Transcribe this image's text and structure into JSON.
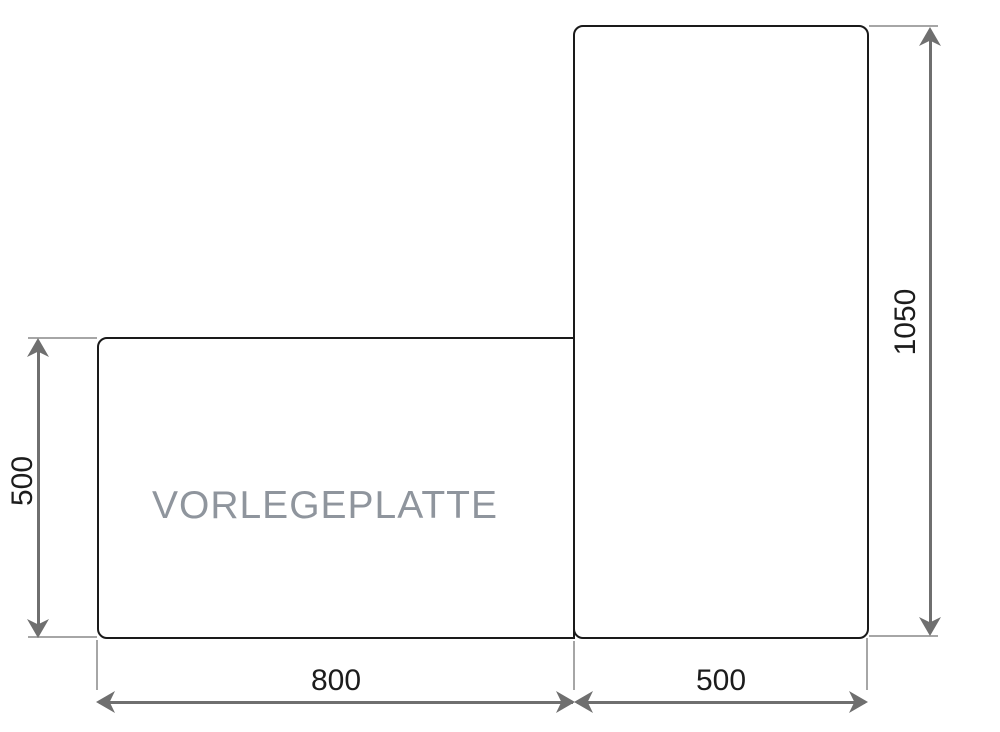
{
  "drawing": {
    "part_label": "VORLEGEPLATTE",
    "dims": {
      "left_height": "500",
      "bottom_left_width": "800",
      "bottom_right_width": "500",
      "right_height": "1050"
    }
  },
  "colors": {
    "background": "#ffffff",
    "outline": "#1a1a1a",
    "dimension_line": "#6f6f6f",
    "extension_line": "#a6a6a6",
    "dimension_text": "#1c1c1c",
    "part_label_text": "#8f959d"
  }
}
